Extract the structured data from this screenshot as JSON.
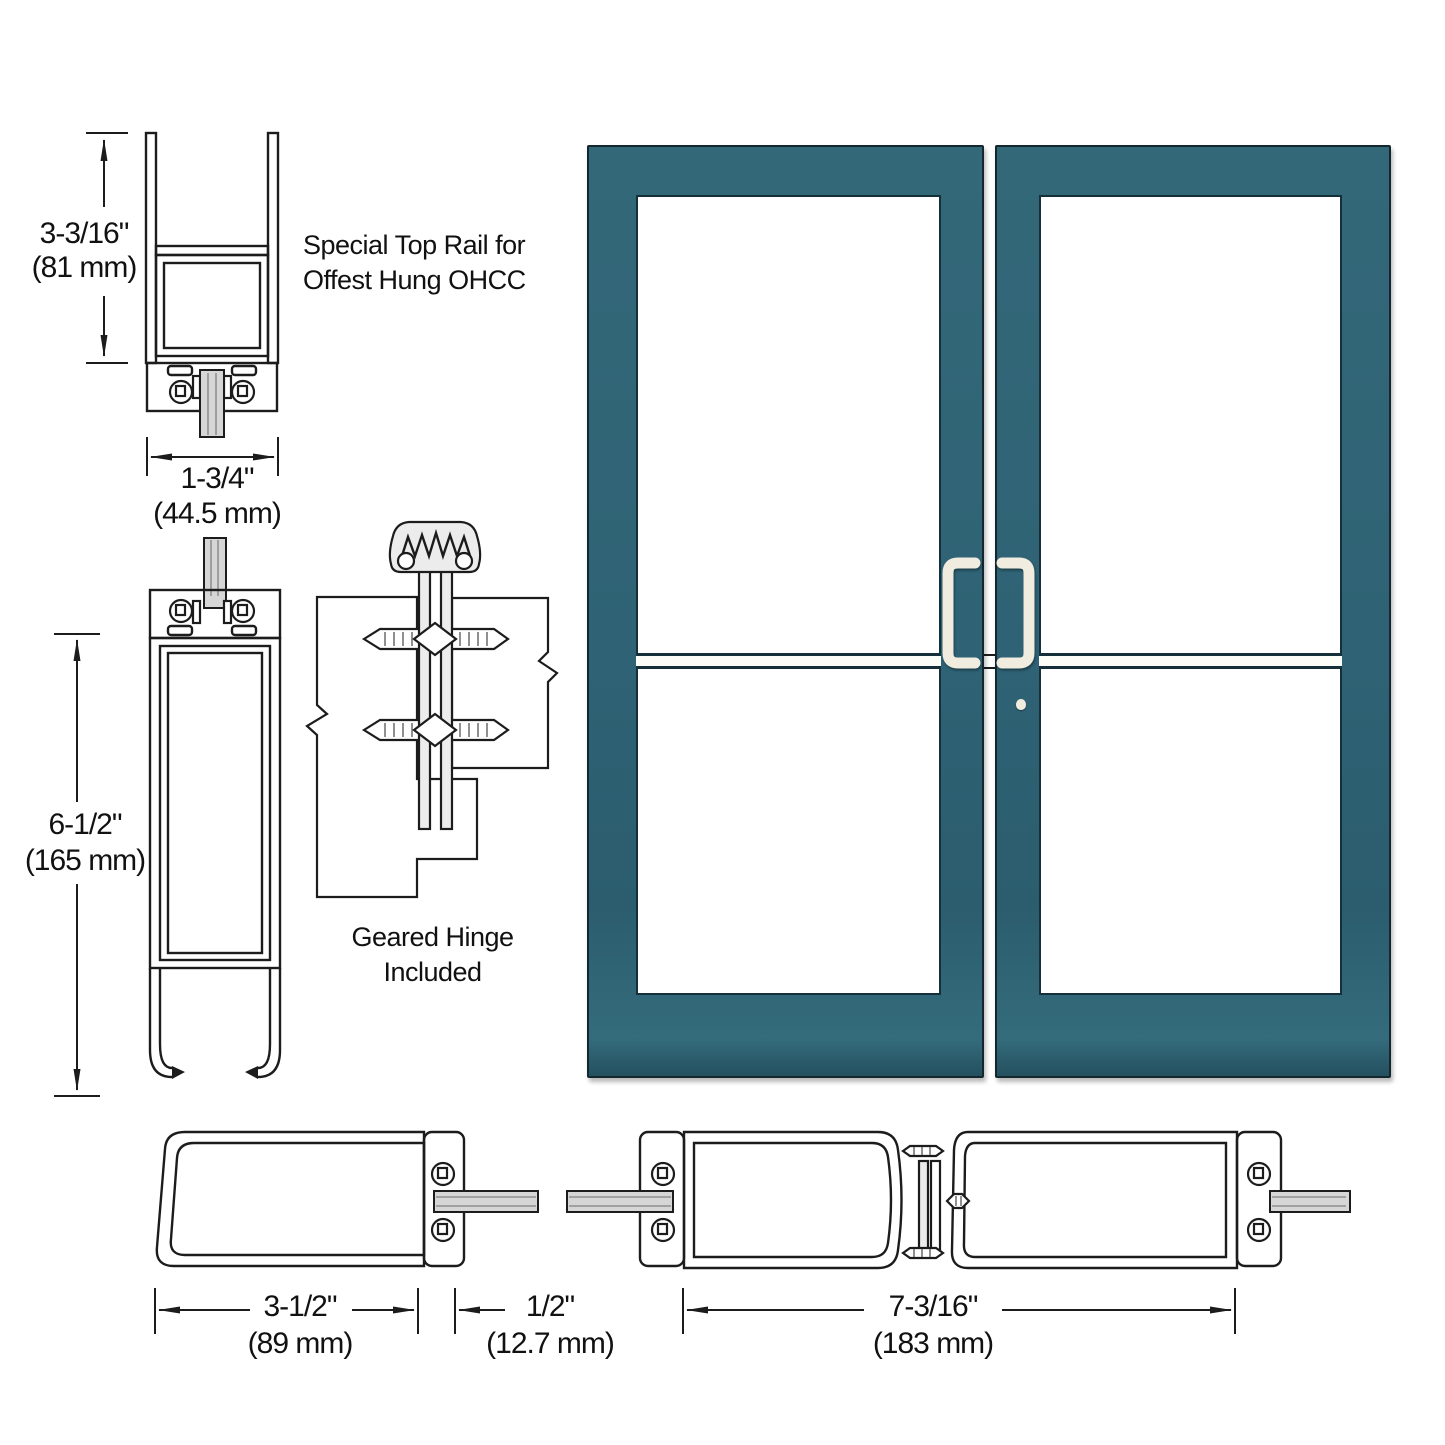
{
  "labels": {
    "special_top_rail_line1": "Special Top Rail for",
    "special_top_rail_line2": "Offest Hung OHCC",
    "geared_hinge_line1": "Geared Hinge",
    "geared_hinge_line2": "Included"
  },
  "dimensions": {
    "top_rail_height": {
      "inches": "3-3/16\"",
      "metric": "(81 mm)"
    },
    "top_rail_depth": {
      "inches": "1-3/4\"",
      "metric": "(44.5 mm)"
    },
    "bottom_rail_height": {
      "inches": "6-1/2\"",
      "metric": "(165 mm)"
    },
    "lock_stile_width": {
      "inches": "3-1/2\"",
      "metric": "(89 mm)"
    },
    "glass_inset": {
      "inches": "1/2\"",
      "metric": "(12.7 mm)"
    },
    "meeting_stiles_width": {
      "inches": "7-3/16\"",
      "metric": "(183 mm)"
    }
  },
  "doors": {
    "count": 2,
    "style": "pair of medium stile storefront doors, half glass divided by midrail",
    "left_door": {
      "handle": "offset pull, right side"
    },
    "right_door": {
      "handle": "offset pull, left side",
      "has_cylinder_lock": true
    }
  },
  "theme": {
    "door-teal": "#2f6375",
    "door-outline": "#14262e",
    "handle": "#f0ecdf",
    "line": "#1c1c1c",
    "glass": "#d6d6d6",
    "text": "#111111"
  }
}
